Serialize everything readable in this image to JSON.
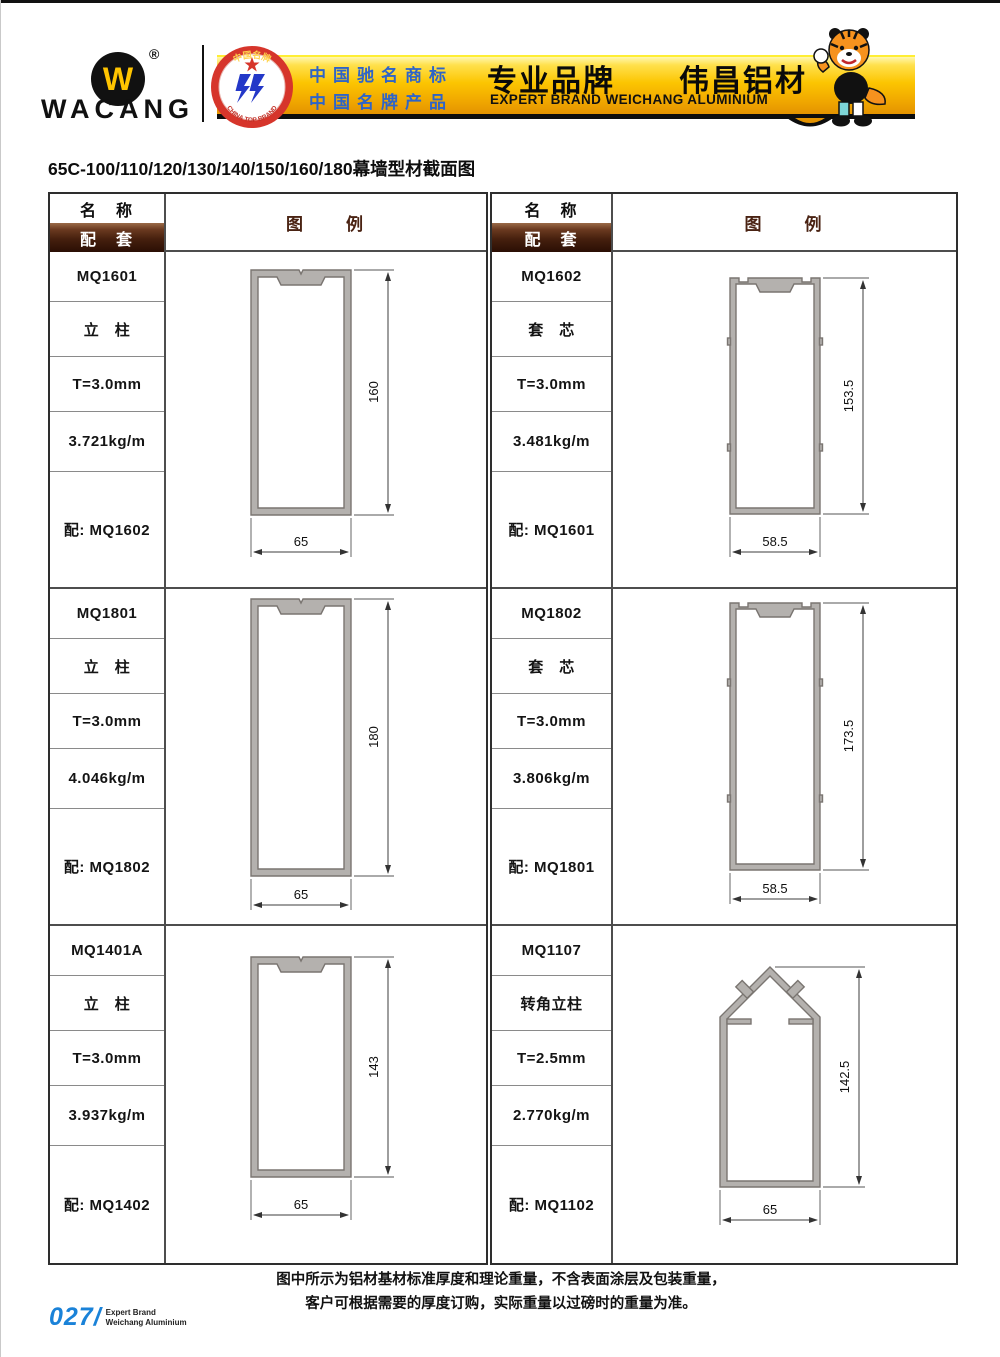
{
  "header": {
    "brand": "WACANG",
    "registered_mark": "®",
    "logo_letter": "W",
    "badge": {
      "top_text": "中国名牌",
      "bottom_text": "CHINA TOP BRAND"
    },
    "claims": {
      "line1": "中国驰名商标",
      "line2": "中国名牌产品"
    },
    "banner_title_cn": "专业品牌　　伟昌铝材",
    "banner_title_en": "EXPERT BRAND WEICHANG ALUMINIUM"
  },
  "page_title": "65C-100/110/120/130/140/150/160/180幕墙型材截面图",
  "table_header": {
    "name": "名　称",
    "match": "配　套",
    "legend": "图　　例"
  },
  "profiles": [
    {
      "model": "MQ1601",
      "type": "立　柱",
      "thickness": "T=3.0mm",
      "weight": "3.721kg/m",
      "match": "配: MQ1602",
      "height_dim": "160",
      "width_dim": "65"
    },
    {
      "model": "MQ1602",
      "type": "套　芯",
      "thickness": "T=3.0mm",
      "weight": "3.481kg/m",
      "match": "配: MQ1601",
      "height_dim": "153.5",
      "width_dim": "58.5"
    },
    {
      "model": "MQ1801",
      "type": "立　柱",
      "thickness": "T=3.0mm",
      "weight": "4.046kg/m",
      "match": "配: MQ1802",
      "height_dim": "180",
      "width_dim": "65"
    },
    {
      "model": "MQ1802",
      "type": "套　芯",
      "thickness": "T=3.0mm",
      "weight": "3.806kg/m",
      "match": "配: MQ1801",
      "height_dim": "173.5",
      "width_dim": "58.5"
    },
    {
      "model": "MQ1401A",
      "type": "立　柱",
      "thickness": "T=3.0mm",
      "weight": "3.937kg/m",
      "match": "配: MQ1402",
      "height_dim": "143",
      "width_dim": "65"
    },
    {
      "model": "MQ1107",
      "type": "转角立柱",
      "thickness": "T=2.5mm",
      "weight": "2.770kg/m",
      "match": "配: MQ1102",
      "height_dim": "142.5",
      "width_dim": "65"
    }
  ],
  "footer": {
    "note1": "图中所示为铝材基材标准厚度和理论重量，不含表面涂层及包装重量，",
    "note2": "客户可根据需要的厚度订购，实际重量以过磅时的重量为准。",
    "page_number": "027/",
    "brand_line1": "Expert Brand",
    "brand_line2": "Weichang Aluminium"
  },
  "colors": {
    "banner_gold": "#fcc501",
    "claims_blue": "#2e64c8",
    "maroon_header": "#46200e",
    "page_number_blue": "#1a82d8",
    "profile_gray": "#b4b1ae"
  }
}
